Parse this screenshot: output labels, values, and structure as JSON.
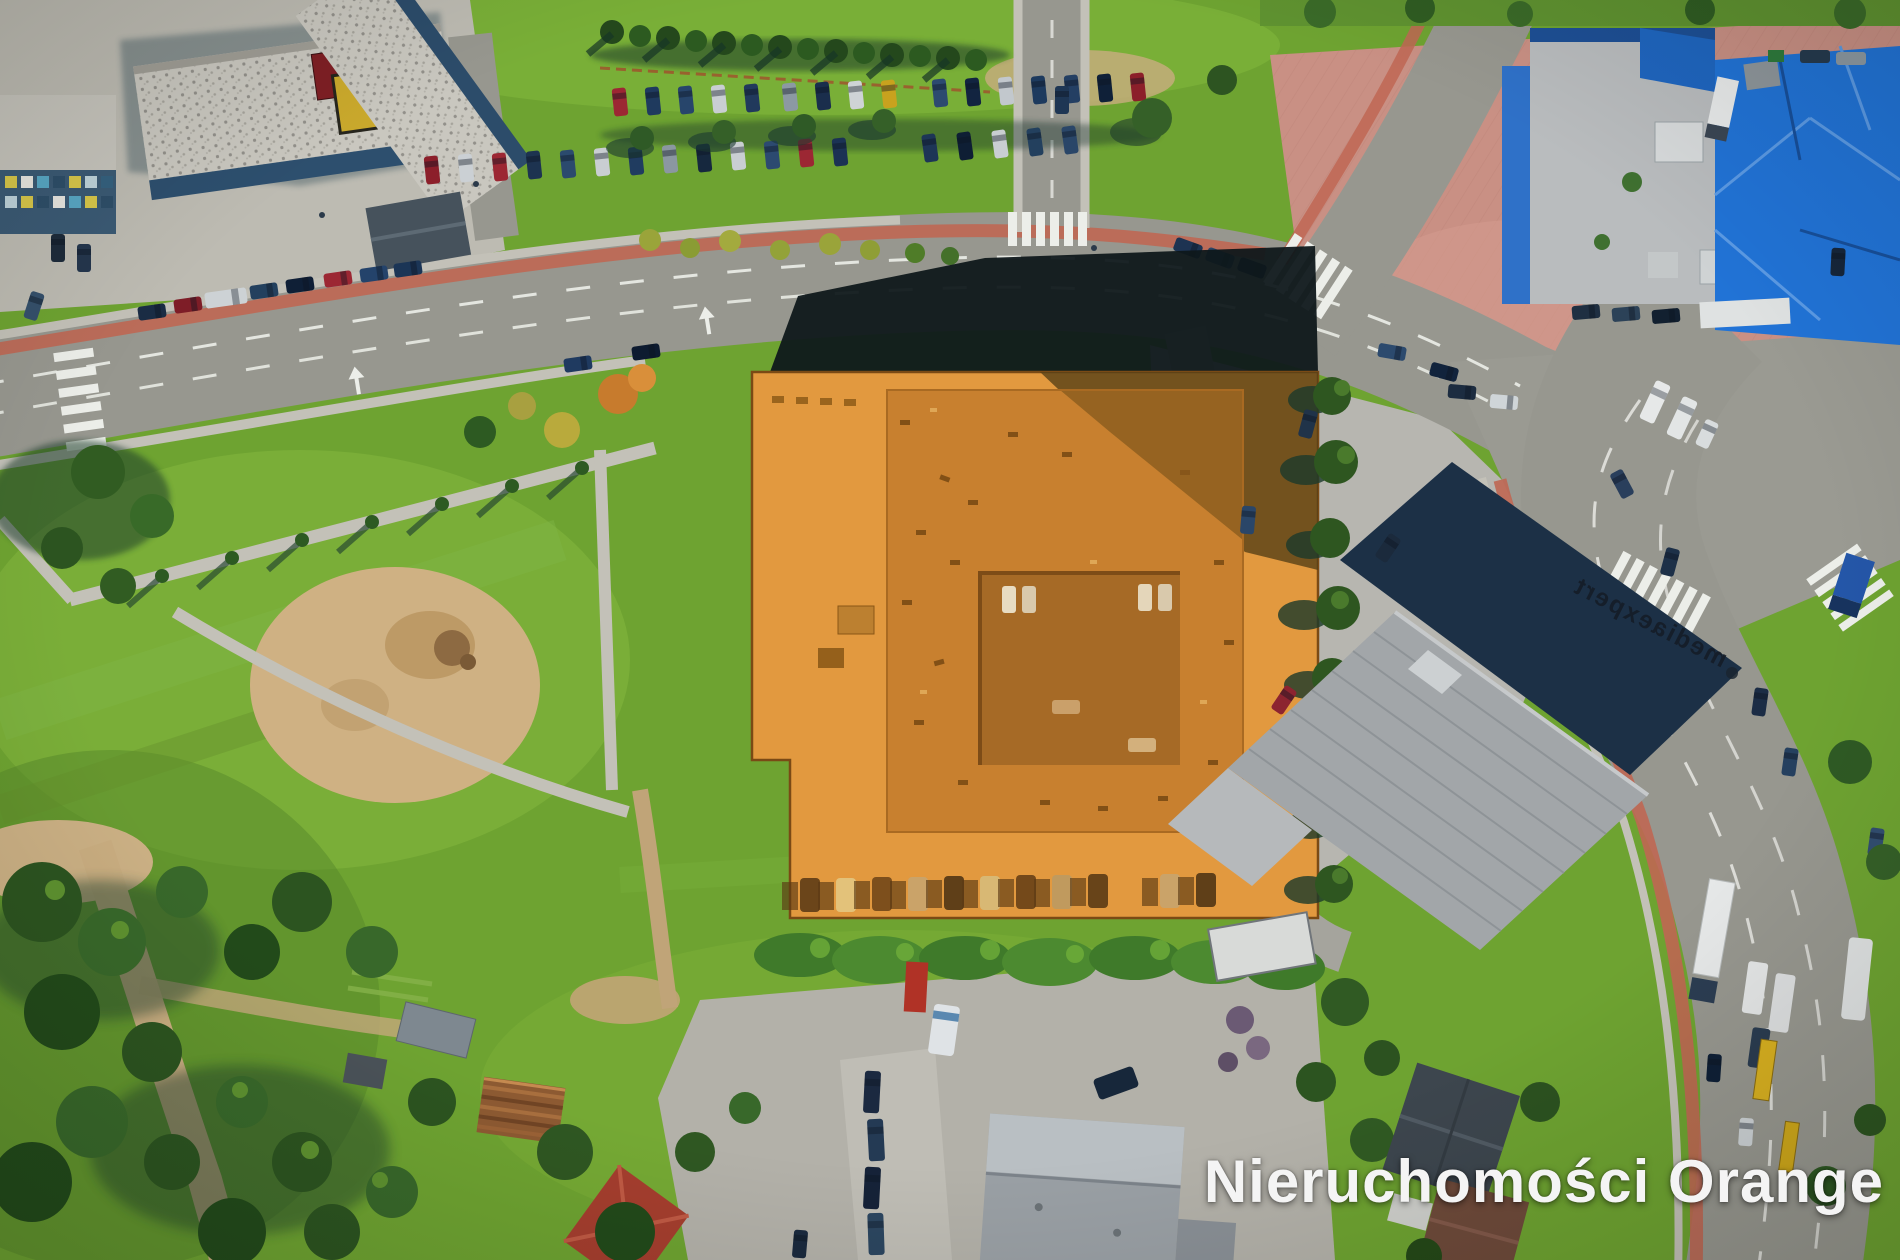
{
  "image": {
    "type": "aerial-drone-photograph",
    "description": "Bird's-eye aerial photo of a commercial property highlighted with an orange overlay, surrounded by streets, parking lots, apartment blocks, an electronics store, a blue-roofed building and green areas",
    "width_px": 1900,
    "height_px": 1260
  },
  "watermark": {
    "text": "Nieruchomości Orange",
    "color": "#f4f4f4"
  },
  "signs": {
    "rooftop_sign": "mediaexpert"
  },
  "highlighted_property": {
    "label": "offered property parcel",
    "shape": "rectangular parcel with notch at south-west corner",
    "building": "square building with inner courtyard",
    "overlay_color": "#e2993f"
  },
  "palette": {
    "grass": "#6ea331",
    "road": "#97978f",
    "bike-path": "#bf6753",
    "highlight": "#e2993f",
    "highlight-roof": "#c8802f",
    "highlight-courtyard": "#a66a26",
    "navy-roof": "#1c3046",
    "blue-roof": "#2173d6",
    "plaza": "#c99084",
    "shadow": "#0e171b",
    "watermark": "#f4f4f4"
  }
}
